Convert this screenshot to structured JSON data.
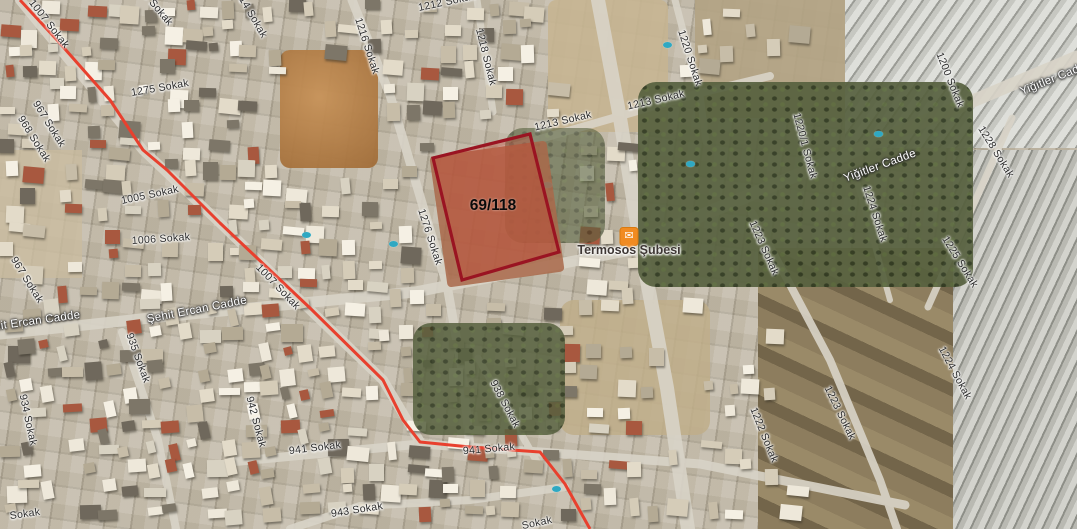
{
  "map": {
    "view_type": "satellite",
    "parcel": {
      "label": "69/118",
      "label_x": 493,
      "label_y": 206,
      "points": [
        [
          433,
          158
        ],
        [
          530,
          134
        ],
        [
          559,
          252
        ],
        [
          462,
          280
        ]
      ]
    },
    "marker": {
      "name": "Termosos Şubesi",
      "icon": "envelope-icon",
      "pin_x": 629,
      "pin_y": 246,
      "label_x": 629,
      "label_y": 243
    },
    "boundary_points": [
      [
        20,
        0
      ],
      [
        57,
        40
      ],
      [
        110,
        100
      ],
      [
        143,
        150
      ],
      [
        167,
        170
      ],
      [
        220,
        223
      ],
      [
        310,
        308
      ],
      [
        383,
        380
      ],
      [
        403,
        420
      ],
      [
        420,
        442
      ],
      [
        470,
        447
      ],
      [
        540,
        452
      ],
      [
        565,
        484
      ],
      [
        590,
        529
      ]
    ],
    "colors": {
      "boundary_line": "#e8402e",
      "parcel_outline": "#9a1422",
      "parcel_fill": "rgba(198,62,45,0.34)",
      "marker_orange": "#f18b21",
      "pool_blue": "#2fa8c2"
    },
    "streets": [
      {
        "text": "1007 Sokak",
        "x": 49,
        "y": 24,
        "rot": 52,
        "kind": "minor"
      },
      {
        "text": "1275 Sokak",
        "x": 152,
        "y": 2,
        "rot": 50,
        "kind": "minor"
      },
      {
        "text": "1214 Sokak",
        "x": 250,
        "y": 12,
        "rot": 60,
        "kind": "minor"
      },
      {
        "text": "1212 Sokak",
        "x": 447,
        "y": 2,
        "rot": -12,
        "kind": "minor"
      },
      {
        "text": "1216 Sokak",
        "x": 367,
        "y": 46,
        "rot": 72,
        "kind": "minor"
      },
      {
        "text": "1218 Sokak",
        "x": 486,
        "y": 57,
        "rot": 76,
        "kind": "minor"
      },
      {
        "text": "1275 Sokak",
        "x": 160,
        "y": 88,
        "rot": -10,
        "kind": "minor"
      },
      {
        "text": "967 Sokak",
        "x": 49,
        "y": 124,
        "rot": 58,
        "kind": "minor"
      },
      {
        "text": "968 Sokak",
        "x": 34,
        "y": 139,
        "rot": 58,
        "kind": "minor"
      },
      {
        "text": "1005 Sokak",
        "x": 150,
        "y": 195,
        "rot": -12,
        "kind": "minor"
      },
      {
        "text": "1006 Sokak",
        "x": 161,
        "y": 239,
        "rot": -4,
        "kind": "minor"
      },
      {
        "text": "967 Sokak",
        "x": 27,
        "y": 280,
        "rot": 58,
        "kind": "minor"
      },
      {
        "text": "1276 Sokak",
        "x": 430,
        "y": 237,
        "rot": 72,
        "kind": "minor"
      },
      {
        "text": "1213 Sokak",
        "x": 563,
        "y": 121,
        "rot": -13,
        "kind": "minor"
      },
      {
        "text": "1213 Sokak",
        "x": 656,
        "y": 100,
        "rot": -13,
        "kind": "minor"
      },
      {
        "text": "1220 Sokak",
        "x": 690,
        "y": 58,
        "rot": 72,
        "kind": "minor"
      },
      {
        "text": "1220/1 Sokak",
        "x": 805,
        "y": 146,
        "rot": 75,
        "kind": "minor"
      },
      {
        "text": "1200 Sokak",
        "x": 950,
        "y": 80,
        "rot": 68,
        "kind": "minor"
      },
      {
        "text": "1228 Sokak",
        "x": 996,
        "y": 152,
        "rot": 58,
        "kind": "minor"
      },
      {
        "text": "1225 Sokak",
        "x": 960,
        "y": 262,
        "rot": 58,
        "kind": "minor"
      },
      {
        "text": "1224 Sokak",
        "x": 875,
        "y": 214,
        "rot": 72,
        "kind": "minor"
      },
      {
        "text": "1224 Sokak",
        "x": 955,
        "y": 373,
        "rot": 62,
        "kind": "minor"
      },
      {
        "text": "1223 Sokak",
        "x": 764,
        "y": 248,
        "rot": 66,
        "kind": "minor"
      },
      {
        "text": "1223 Sokak",
        "x": 840,
        "y": 413,
        "rot": 64,
        "kind": "minor"
      },
      {
        "text": "1222 Sokak",
        "x": 764,
        "y": 435,
        "rot": 68,
        "kind": "minor"
      },
      {
        "text": "1007 Sokak",
        "x": 278,
        "y": 287,
        "rot": 46,
        "kind": "minor"
      },
      {
        "text": "934 Sokak",
        "x": 28,
        "y": 420,
        "rot": 78,
        "kind": "minor"
      },
      {
        "text": "935 Sokak",
        "x": 138,
        "y": 358,
        "rot": 70,
        "kind": "minor"
      },
      {
        "text": "942 Sokak",
        "x": 256,
        "y": 422,
        "rot": 75,
        "kind": "minor"
      },
      {
        "text": "941 Sokak",
        "x": 315,
        "y": 448,
        "rot": -7,
        "kind": "minor"
      },
      {
        "text": "941 Sokak",
        "x": 489,
        "y": 449,
        "rot": -5,
        "kind": "minor"
      },
      {
        "text": "938 Sokak",
        "x": 505,
        "y": 404,
        "rot": 62,
        "kind": "minor"
      },
      {
        "text": "943 Sokak",
        "x": 357,
        "y": 510,
        "rot": -9,
        "kind": "minor"
      },
      {
        "text": "Sokak",
        "x": 537,
        "y": 523,
        "rot": -12,
        "kind": "minor"
      },
      {
        "text": "Sokak",
        "x": 25,
        "y": 514,
        "rot": -8,
        "kind": "minor"
      },
      {
        "text": "Şehit Ercan Cadde",
        "x": 30,
        "y": 322,
        "rot": -8,
        "kind": "major"
      },
      {
        "text": "Şehit Ercan Cadde",
        "x": 197,
        "y": 310,
        "rot": -11,
        "kind": "major"
      },
      {
        "text": "Yiğitler Cadde",
        "x": 880,
        "y": 166,
        "rot": -20,
        "kind": "major"
      },
      {
        "text": "Yiğitler Cadde",
        "x": 1056,
        "y": 78,
        "rot": -22,
        "kind": "major"
      }
    ]
  }
}
